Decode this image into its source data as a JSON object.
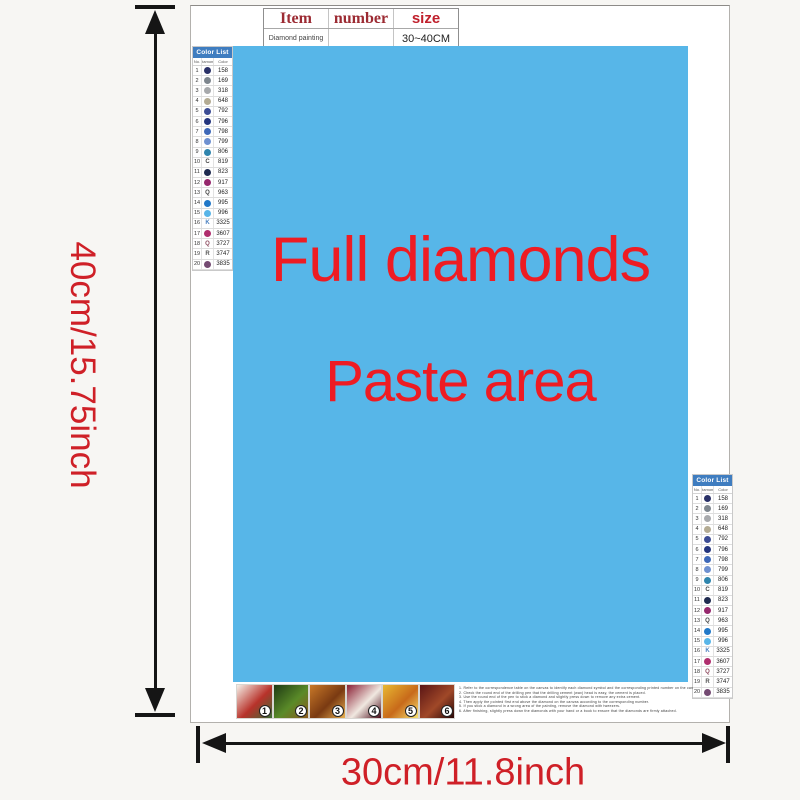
{
  "dimensions": {
    "height_label": "40cm/15.75inch",
    "width_label": "30cm/11.8inch",
    "label_color": "#cf2027"
  },
  "spec_table": {
    "headers": [
      "Item",
      "number",
      "size"
    ],
    "row": [
      "Diamond painting",
      "",
      "30~40CM"
    ]
  },
  "canvas": {
    "bg": "#57b6e8",
    "text_color": "#ee1c23",
    "line1": "Full diamonds",
    "line2": "Paste area"
  },
  "color_list": {
    "title": "Color List",
    "columns": [
      "No.",
      "Diamond",
      "Color"
    ],
    "rows": [
      {
        "no": "1",
        "symbol": "",
        "swatch": "#2a3168",
        "code": "158"
      },
      {
        "no": "2",
        "symbol": "",
        "swatch": "#7e868e",
        "code": "169"
      },
      {
        "no": "3",
        "symbol": "",
        "swatch": "#a7a9ac",
        "code": "318"
      },
      {
        "no": "4",
        "symbol": "",
        "swatch": "#b3ab93",
        "code": "648"
      },
      {
        "no": "5",
        "symbol": "",
        "swatch": "#3c4c94",
        "code": "792"
      },
      {
        "no": "6",
        "symbol": "",
        "swatch": "#24357e",
        "code": "796"
      },
      {
        "no": "7",
        "symbol": "",
        "swatch": "#3e68b8",
        "code": "798"
      },
      {
        "no": "8",
        "symbol": "",
        "swatch": "#6e90d0",
        "code": "799"
      },
      {
        "no": "9",
        "symbol": "",
        "swatch": "#2f85ad",
        "code": "806"
      },
      {
        "no": "10",
        "symbol": "C",
        "symbol_color": "#444444",
        "swatch": "",
        "code": "819"
      },
      {
        "no": "11",
        "symbol": "",
        "swatch": "#1f2b50",
        "code": "823"
      },
      {
        "no": "12",
        "symbol": "",
        "swatch": "#96286d",
        "code": "917"
      },
      {
        "no": "13",
        "symbol": "Q",
        "symbol_color": "#444444",
        "swatch": "",
        "code": "963"
      },
      {
        "no": "14",
        "symbol": "",
        "swatch": "#2178c8",
        "code": "995"
      },
      {
        "no": "15",
        "symbol": "",
        "swatch": "#58b5e8",
        "code": "996"
      },
      {
        "no": "16",
        "symbol": "K",
        "symbol_color": "#4a80c0",
        "swatch": "",
        "code": "3325"
      },
      {
        "no": "17",
        "symbol": "",
        "swatch": "#b02e6e",
        "code": "3607"
      },
      {
        "no": "18",
        "symbol": "Q",
        "symbol_color": "#8c4a5e",
        "swatch": "",
        "code": "3727"
      },
      {
        "no": "19",
        "symbol": "R",
        "symbol_color": "#555555",
        "swatch": "",
        "code": "3747"
      },
      {
        "no": "20",
        "symbol": "",
        "swatch": "#744a72",
        "code": "3835"
      }
    ]
  },
  "thumbnails": [
    {
      "num": "1",
      "colors": [
        "#f5f0e8",
        "#b8322a",
        "#3a6b35"
      ]
    },
    {
      "num": "2",
      "colors": [
        "#1e3a14",
        "#5a8a28",
        "#8c5a1e"
      ]
    },
    {
      "num": "3",
      "colors": [
        "#c87828",
        "#7a3a12",
        "#e8b050"
      ]
    },
    {
      "num": "4",
      "colors": [
        "#8a2035",
        "#f0e8e0",
        "#4a0a18"
      ]
    },
    {
      "num": "5",
      "colors": [
        "#e8b832",
        "#c86a1a",
        "#f5e070"
      ]
    },
    {
      "num": "6",
      "colors": [
        "#5a1515",
        "#a04828",
        "#2a0808"
      ]
    }
  ],
  "fine_print": {
    "lines": [
      "1. Refer to the correspondence table on the canvas to identify each diamond symbol and the corresponding printed number on the canvas.",
      "2. Check the round end of the drilling pen that the drilling cement (wax) head is easy, the cement is placed.",
      "3. Use the round end of the pen to stick a diamond and slightly press down to remove any extra cement.",
      "4. Then apply the pointed first end above the diamond on the canvas according to the corresponding number.",
      "5. If you stick a diamond in a wrong area of the painting, remove the diamond with tweezers.",
      "6. After finishing, slightly press down the diamonds with your hand or a book to ensure that the diamonds are firmly attached."
    ]
  }
}
